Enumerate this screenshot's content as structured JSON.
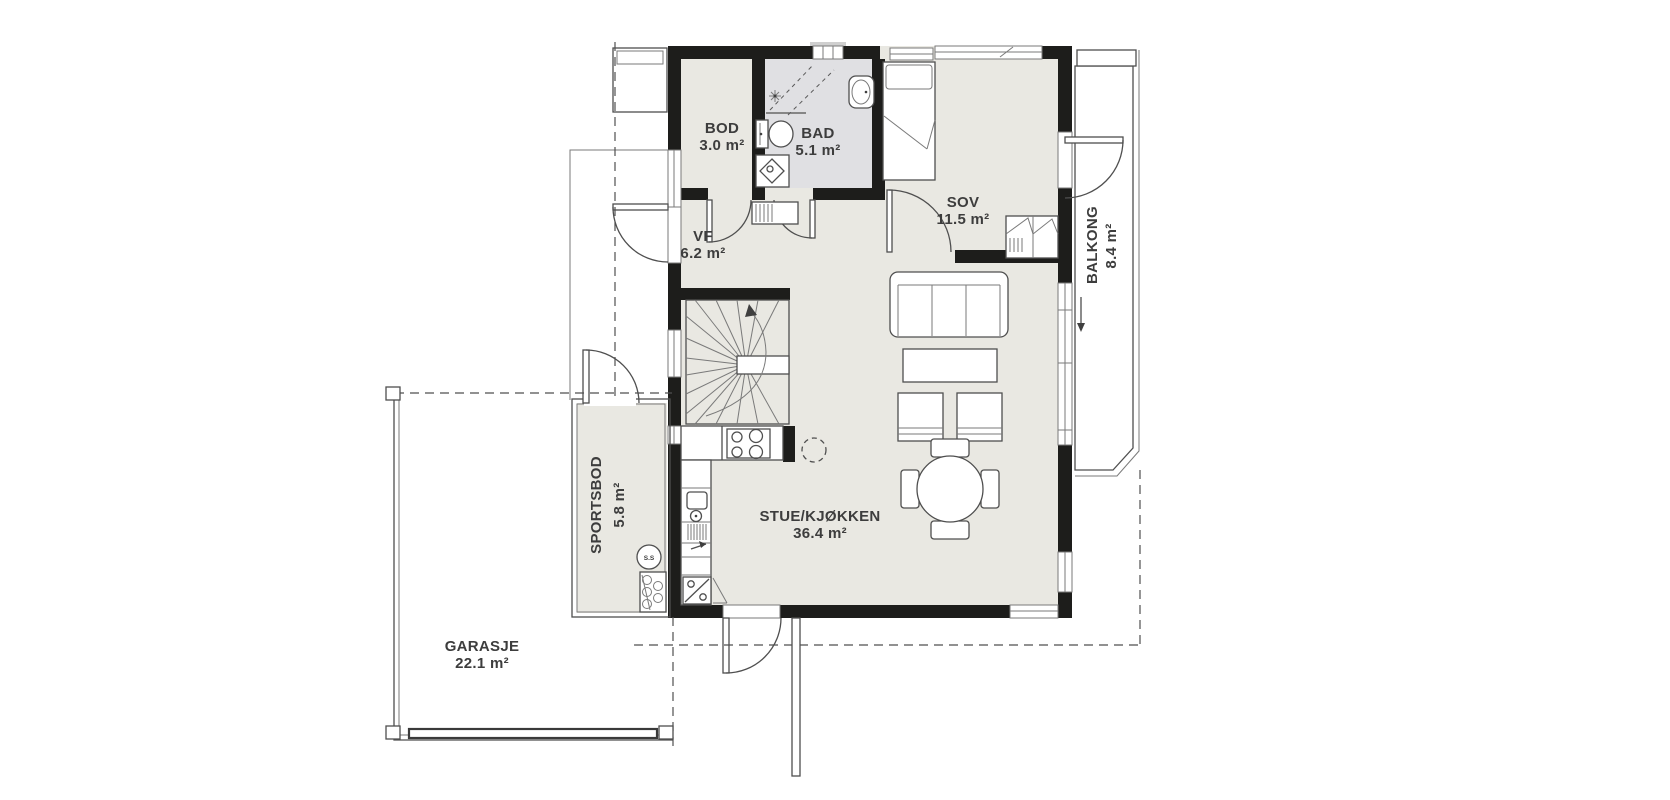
{
  "rooms": {
    "bod": {
      "name": "BOD",
      "area": "3.0 m²"
    },
    "bad": {
      "name": "BAD",
      "area": "5.1 m²"
    },
    "sov": {
      "name": "SOV",
      "area": "11.5 m²"
    },
    "vf": {
      "name": "VF",
      "area": "6.2 m²"
    },
    "stue_kjokken": {
      "name": "STUE/KJØKKEN",
      "area": "36.4 m²"
    },
    "balkong": {
      "name": "BALKONG",
      "area": "8.4 m²"
    },
    "sportsbod": {
      "name": "SPORTSBOD",
      "area": "5.8 m²"
    },
    "garasje": {
      "name": "GARASJE",
      "area": "22.1 m²"
    }
  },
  "annotations": {
    "water_heater_label": "S.S"
  },
  "icons": {
    "staircase-icon": "winder staircase with walkline arrow",
    "stove-icon": "cooktop with four burners",
    "kitchen-sink-icon": "kitchen sink with faucet",
    "dishwasher-icon": "hatched appliance with arrow",
    "fridge-freezer-icon": "fridge/freezer with diagonal split symbol",
    "toilet-icon": "toilet",
    "shower-icon": "corner shower with dashed glass walls",
    "washing-machine-icon": "square with rotated diamond",
    "bathroom-sink-icon": "washbasin",
    "bed-icon": "bed with pillow and folded blanket",
    "wardrobe-icon": "wardrobe with hanger hatching",
    "sofa-icon": "three-seat sofa",
    "coffee-table-icon": "coffee table",
    "armchair-icon": "armchair",
    "stool-icon": "dashed round stool",
    "dining-table-icon": "round dining table with four chairs",
    "water-heater-icon": "circle labelled S.S",
    "pipes-icon": "cabinet with pipe circles",
    "door-swing-icon": "quarter-circle door swing",
    "balcony-arrow-icon": "downward direction arrow",
    "garage-door-icon": "garage door bar"
  },
  "colors": {
    "background": "#ffffff",
    "wall": "#1d1d1b",
    "floor": "#e9e8e2",
    "bathroom_floor": "#e0e0e3",
    "line": "#4f4f4f",
    "deck_stripe": "#c7c7c7",
    "text": "#3d3d3d"
  }
}
